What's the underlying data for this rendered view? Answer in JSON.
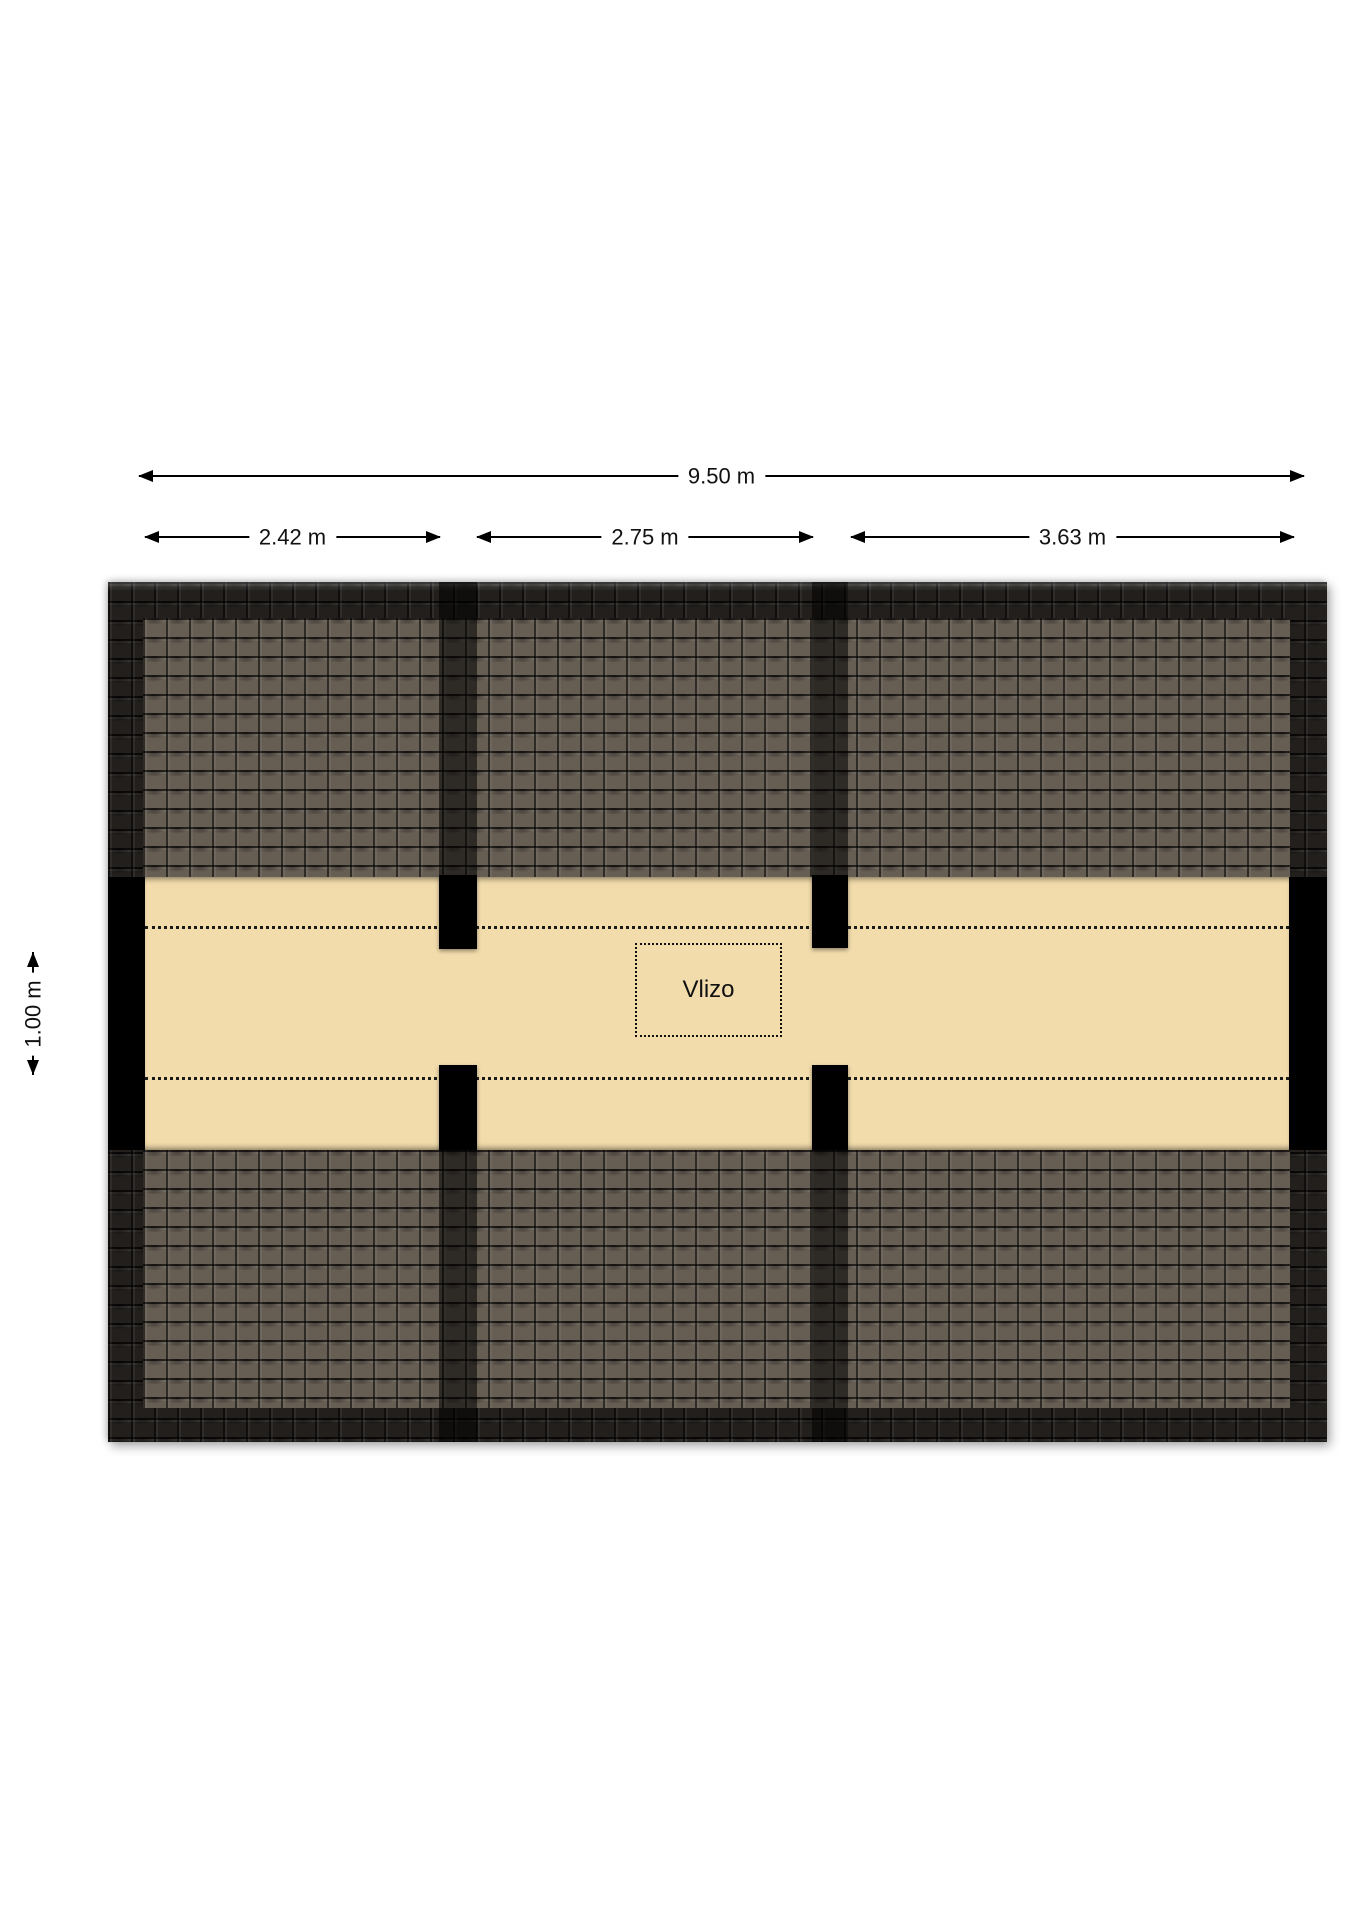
{
  "plan": {
    "title": "attic-floor-plan",
    "colors": {
      "background": "#ffffff",
      "floor_beige": "#f2dcac",
      "roof_outer": "#221f1c",
      "roof_inner": "#665d53",
      "wall": "#000000"
    }
  },
  "dimensions": {
    "total": {
      "label": "9.50 m"
    },
    "segments": [
      {
        "label": "2.42 m"
      },
      {
        "label": "2.75 m"
      },
      {
        "label": "3.63 m"
      }
    ],
    "vertical": {
      "label": "1.00 m"
    }
  },
  "rooms": [
    {
      "label": "Vlizo"
    }
  ]
}
